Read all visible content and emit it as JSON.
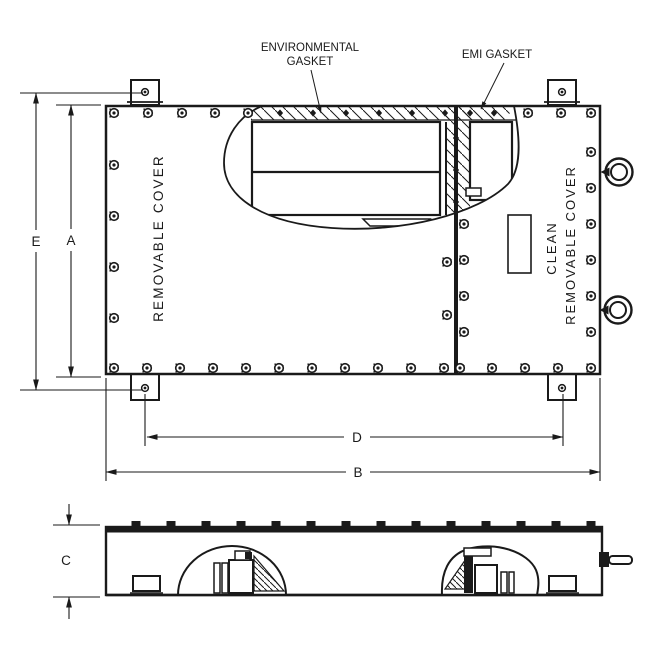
{
  "callouts": {
    "environmental_gasket": {
      "line1": "ENVIRONMENTAL",
      "line2": "GASKET"
    },
    "emi_gasket": "EMI GASKET"
  },
  "covers": {
    "left_label": "REMOVABLE COVER",
    "right_label_line1": "CLEAN",
    "right_label_line2": "REMOVABLE COVER"
  },
  "dimensions": {
    "E": "E",
    "A": "A",
    "D": "D",
    "B": "B",
    "C": "C"
  },
  "colors": {
    "line": "#1a1a1a",
    "background": "#ffffff"
  }
}
